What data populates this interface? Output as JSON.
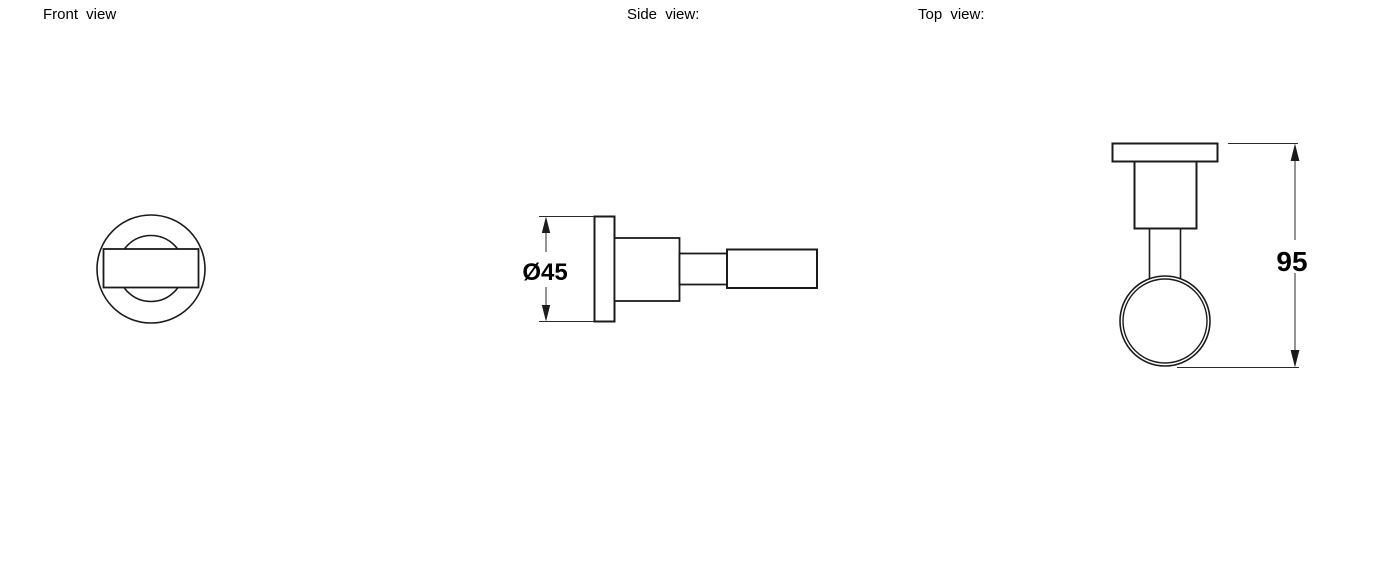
{
  "colors": {
    "background": "#ffffff",
    "line": "#1b1b1b",
    "text": "#000000"
  },
  "views": {
    "front": {
      "label": "Front view"
    },
    "side": {
      "label": "Side view:",
      "dimension_label": "Ø45"
    },
    "top": {
      "label": "Top view:",
      "dimension_label": "95"
    }
  }
}
